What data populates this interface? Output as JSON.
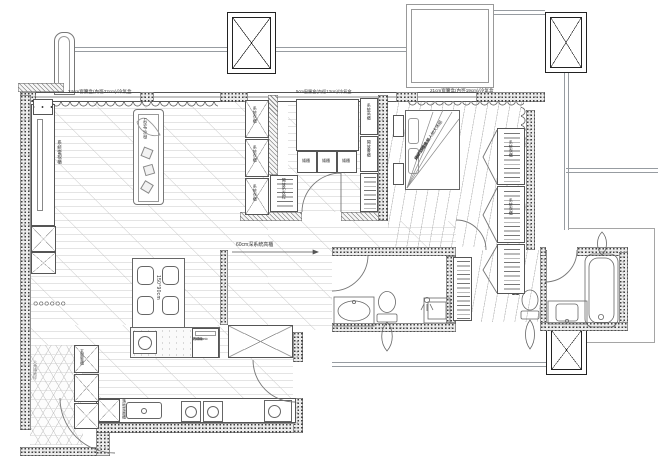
{
  "plan": {
    "title": "residential floor plan",
    "annotations": {
      "curtain_left": "24cm窗簾盒(內徑22cm)/冷氣盒",
      "curtain_mid": "5cm窗簾盒(內徑13cm)/冷氣盒",
      "curtain_right": "21cm窗簾盒(內徑19cm)/冷氣盒",
      "corridor_note": "60cm深系統高櫃",
      "dining_table_size": "150*90cm",
      "bed_line1": "Afer 白橡木雙人加大床組",
      "bed_line2": "190*195.5cm",
      "bed_line3": "床頭附插座",
      "dishwasher_line1": "Panasonic",
      "dishwasher_line2": "洗碗機",
      "dishwasher_line3": "W45cm",
      "tv_wall": "系統電視櫃",
      "sofa": "L型布沙發",
      "wardrobe_unit": "系統衣櫃",
      "open_hanger": "開放吊衣桿",
      "study_cab_1": "系統高櫃",
      "study_cab_2": "開放書櫃",
      "low_cabinet": "矮櫃",
      "appliance_tall": "落地電器櫃",
      "shoe_cabinet": "玄關鞋櫃",
      "hex_tile": "六角磚地坪",
      "master_wardrobe": "系統衣櫃"
    },
    "colors": {
      "wall_line": "#555555",
      "hatch": "#8a8a8a",
      "rail_gray": "#979ca1",
      "floor_line": "#c9c9c9",
      "text": "#333333"
    }
  }
}
